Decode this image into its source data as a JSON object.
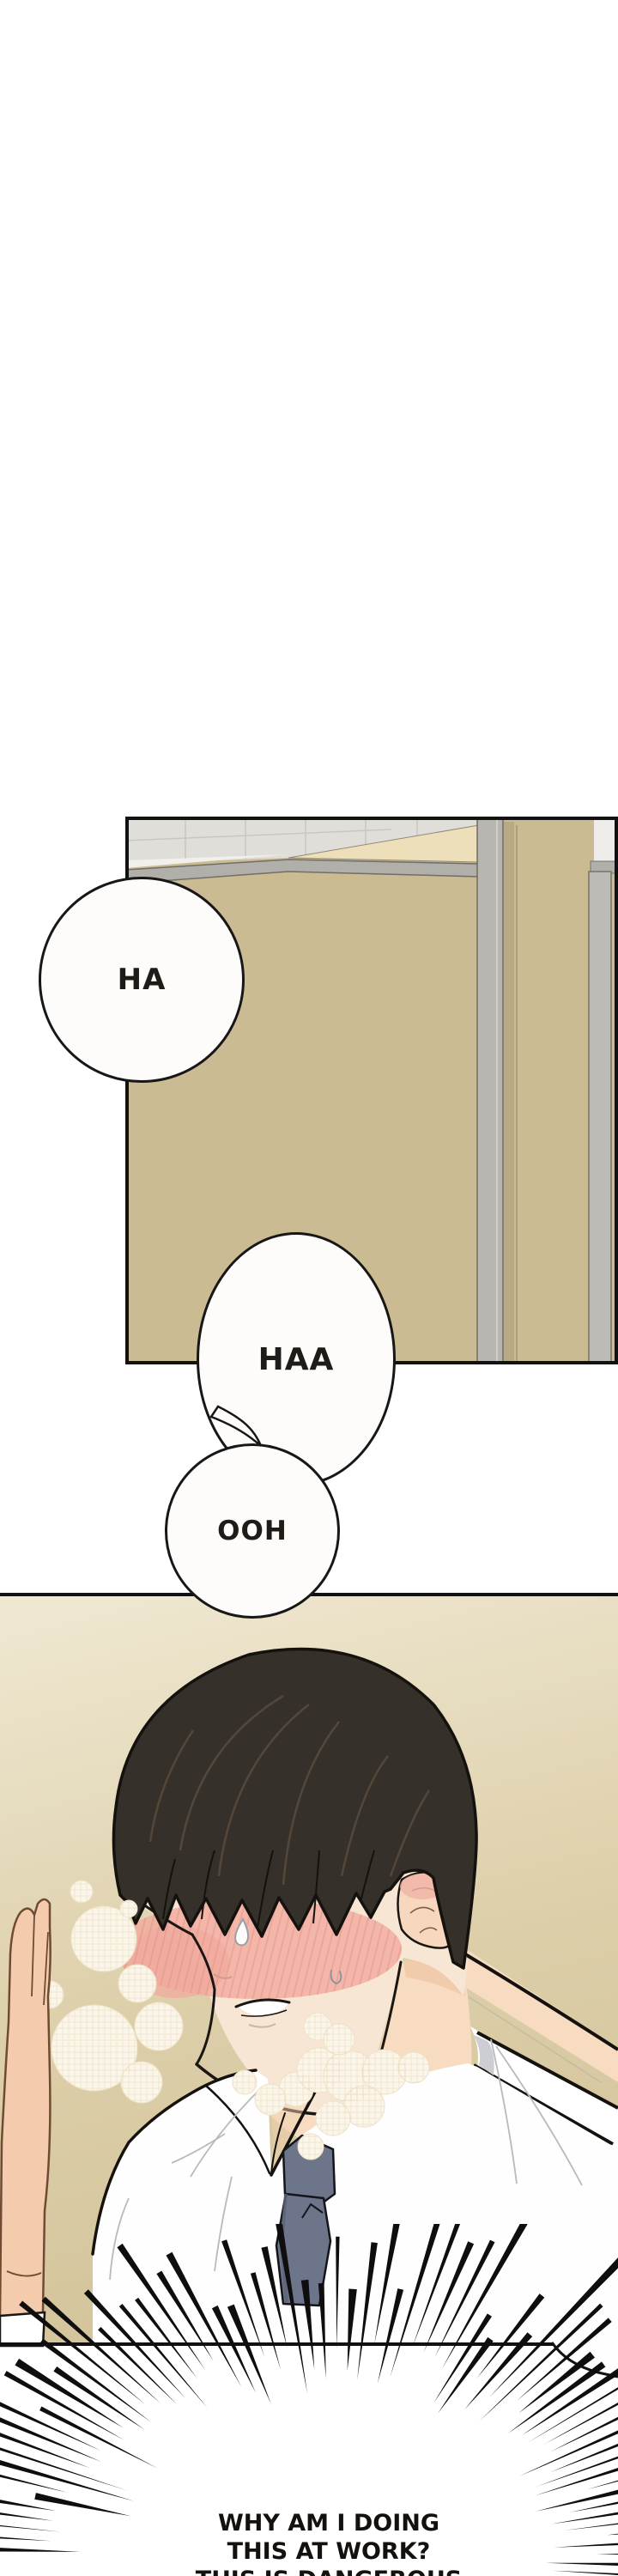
{
  "comic": {
    "type": "webtoon-episode-strip",
    "panel1": {
      "name": "bathroom-stall-scene",
      "colors": {
        "wall_tan": "#cabb92",
        "cream_wedge": "#ecdfba",
        "ceiling_gray": "#e0ded9",
        "rail_gray": "#b1afaa",
        "post_gray": "#b8b6b1",
        "border_black": "#111111"
      }
    },
    "bubbles": {
      "ha": {
        "text": "HA"
      },
      "haa": {
        "text": "HAA"
      },
      "ooh": {
        "text": "OOH"
      }
    },
    "panel2": {
      "name": "blushing-man-scene",
      "colors": {
        "bg_top": "#eee6cf",
        "bg_bottom": "#d2c39a",
        "hair_brown": "#35302a",
        "skin": "#f8e6d4",
        "blush_pink": "#f1aa9e",
        "tie_slate": "#6d758a",
        "shirt_white": "#fefefe"
      }
    },
    "caption": {
      "lines": [
        "WHY AM I DOING",
        "THIS AT WORK?",
        "THIS IS DANGEROUS"
      ]
    }
  }
}
